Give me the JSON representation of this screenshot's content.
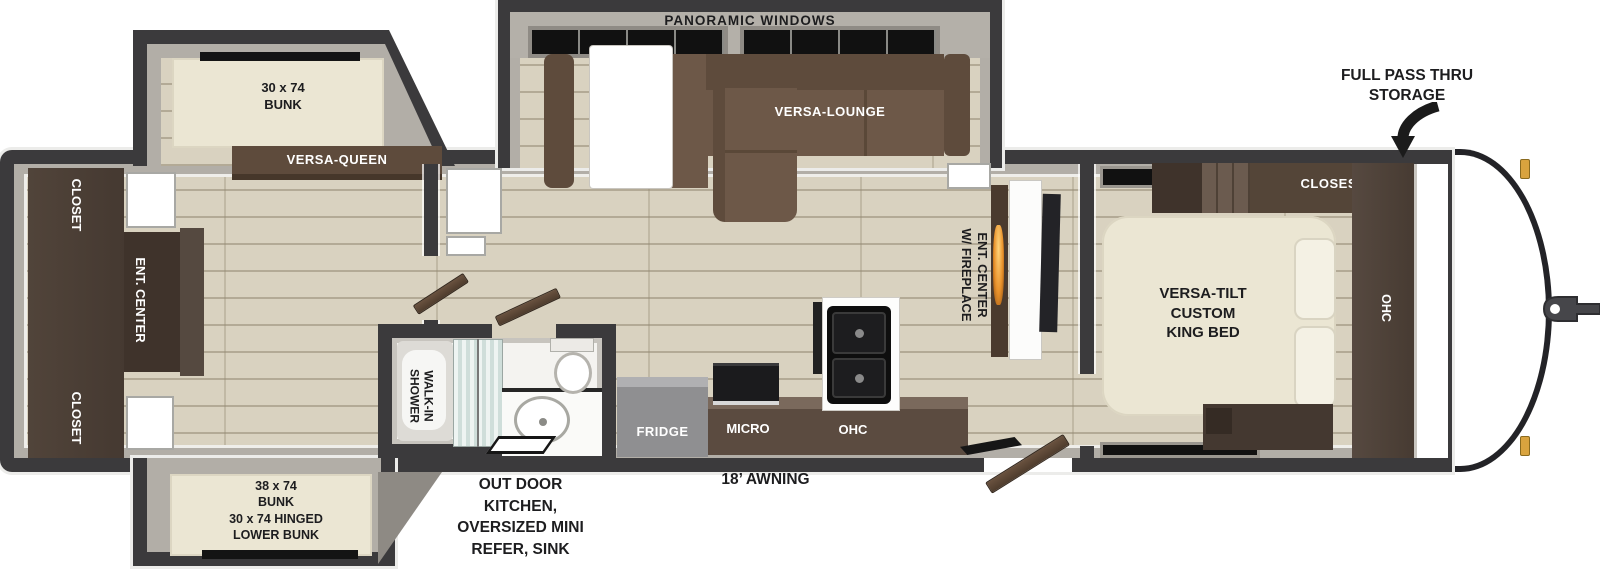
{
  "title": "Travel trailer floor plan diagram",
  "colors": {
    "wall": "#3b3a3c",
    "floor": "#d9d2c0",
    "sofa": "#6d5848",
    "sofa-dark": "#5e4b3c",
    "cabinet": "#4b3e34",
    "bed-cream": "#ebe6d3",
    "fridge-gray": "#8f8f91",
    "flame": "#e8912b",
    "amber": "#d9a33e"
  },
  "floorplan": {
    "front": {
      "pass_thru": [
        "FULL PASS THRU",
        "STORAGE"
      ]
    },
    "bedroom": {
      "closet": "CLOSEST",
      "ohc": "OHC",
      "bed": [
        "VERSA-TILT",
        "CUSTOM",
        "KING BED"
      ]
    },
    "living": {
      "panoramic_windows": "PANORAMIC WINDOWS",
      "lounge": "VERSA-LOUNGE",
      "ent_center": [
        "ENT. CENTER",
        "W/ FIREPLACE"
      ]
    },
    "kitchen": {
      "fridge": "FRIDGE",
      "micro": "MICRO",
      "ohc": "OHC"
    },
    "bathroom": {
      "shower": [
        "WALK-IN",
        "SHOWER"
      ]
    },
    "bunkroom": {
      "top_bunk": [
        "30 x 74",
        "BUNK"
      ],
      "versa_queen": "VERSA-QUEEN",
      "closet_top": "CLOSET",
      "ent_center": "ENT. CENTER",
      "closet_bottom": "CLOSET",
      "lower_bunk": [
        "38 x 74",
        "BUNK",
        "30 x 74 HINGED",
        "LOWER BUNK"
      ]
    },
    "exterior": {
      "awning": "18’ AWNING",
      "outdoor_kitchen": [
        "OUT DOOR",
        "KITCHEN,",
        "OVERSIZED MINI",
        "REFER, SINK"
      ]
    }
  }
}
